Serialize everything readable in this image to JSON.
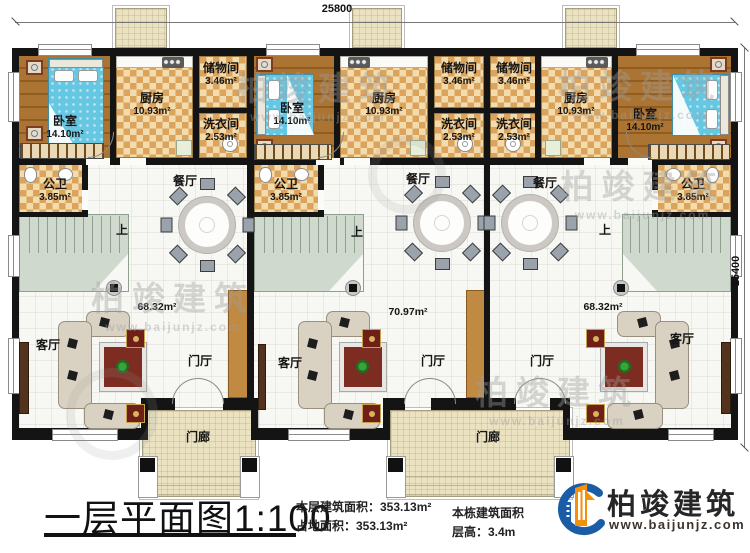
{
  "title_block": {
    "title": "一层平面图1:100",
    "stat_floor_area": "本层建筑面积：353.13m²",
    "stat_footprint": "占地面积：353.13m²",
    "stat_building_area_label": "本栋建筑面积",
    "stat_floor_height": "层高：3.4m"
  },
  "logo": {
    "name": "柏竣建筑",
    "url": "www.baijunjz.com",
    "blue": "#1b5ca6",
    "orange": "#f39208"
  },
  "watermark": {
    "name": "柏竣建筑",
    "url": "www.baijunjz.com"
  },
  "dimensions": {
    "width": "25800",
    "depth": "15400"
  },
  "labels": {
    "bedroom": {
      "name": "卧室",
      "area": "14.10m²"
    },
    "kitchen": {
      "name": "厨房",
      "area": "10.93m²"
    },
    "storage": {
      "name": "储物间",
      "area": "3.46m²"
    },
    "laundry": {
      "name": "洗衣间",
      "area": "2.53m²"
    },
    "bathroom": {
      "name": "公卫",
      "area": "3.85m²"
    },
    "dining": "餐厅",
    "living": "客厅",
    "foyer": "门厅",
    "porch": "门廊",
    "stairs_up": "上"
  },
  "unit_areas": {
    "left": "68.32m²",
    "middle": "70.97m²",
    "right": "68.32m²"
  },
  "colors": {
    "wall": "#141414",
    "wood_floor": "#a9732f",
    "tile": "#dca75f",
    "stairs": "#cfd9ce",
    "bed": "#64c6e2",
    "porch_floor": "#ebe2c2"
  }
}
